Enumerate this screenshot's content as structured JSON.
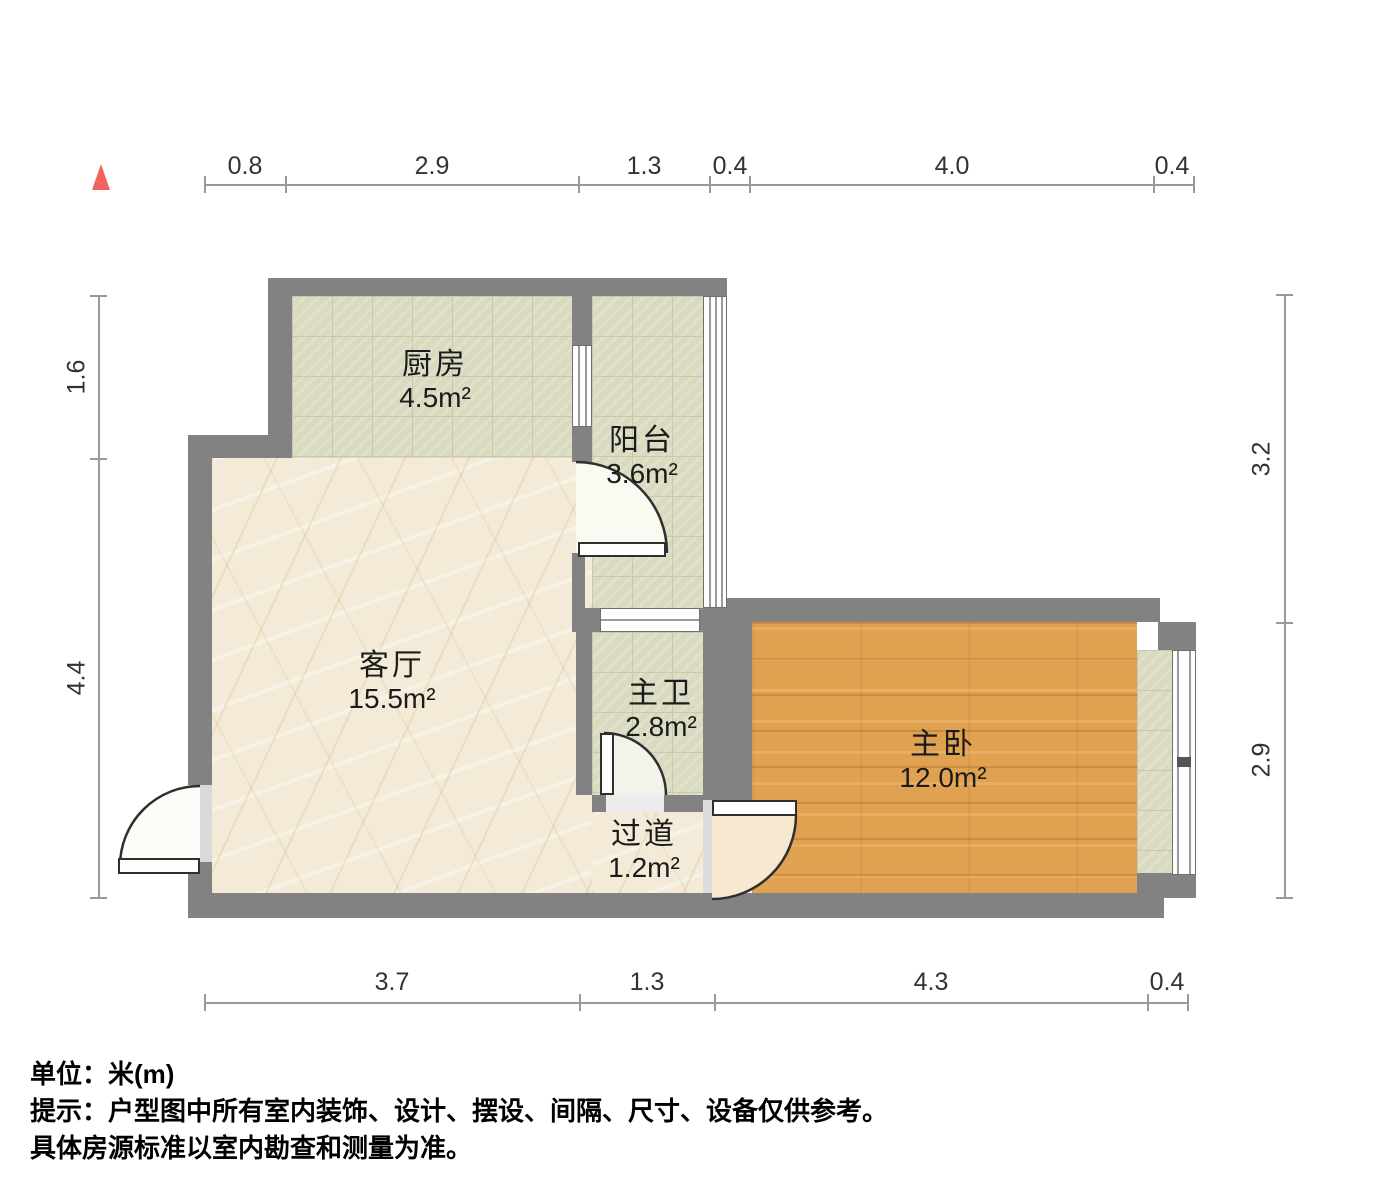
{
  "title": "户型图",
  "rooms": {
    "kitchen": {
      "name": "厨房",
      "area": "4.5m²"
    },
    "balcony": {
      "name": "阳台",
      "area": "3.6m²"
    },
    "living": {
      "name": "客厅",
      "area": "15.5m²"
    },
    "bath": {
      "name": "主卫",
      "area": "2.8m²"
    },
    "bedroom": {
      "name": "主卧",
      "area": "12.0m²"
    },
    "hall": {
      "name": "过道",
      "area": "1.2m²"
    }
  },
  "dimensions": {
    "top": [
      "0.8",
      "2.9",
      "1.3",
      "0.4",
      "4.0",
      "0.4"
    ],
    "bottom": [
      "3.7",
      "1.3",
      "4.3",
      "0.4"
    ],
    "left": [
      "1.6",
      "4.4"
    ],
    "right": [
      "3.2",
      "2.9"
    ]
  },
  "notes": {
    "unit": "单位：米(m)",
    "line1": "提示：户型图中所有室内装饰、设计、摆设、间隔、尺寸、设备仅供参考。",
    "line2": "具体房源标准以室内勘查和测量为准。"
  },
  "colors": {
    "wall": "#828282",
    "tile_floor": "#d9dabf",
    "marble_floor": "#f3ebd8",
    "wood_floor": "#e0a150",
    "compass_north": "#f2625e",
    "dimension_line": "#999999",
    "text": "#1b1b1b"
  }
}
